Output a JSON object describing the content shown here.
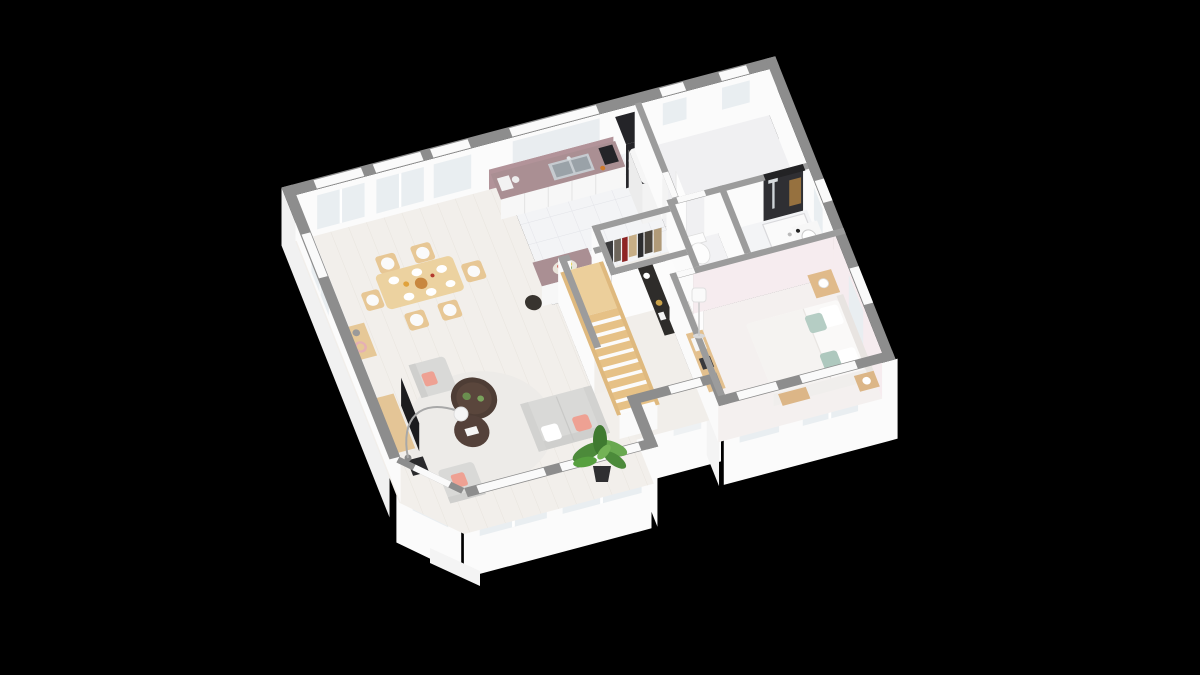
{
  "scene": {
    "background": "#000000",
    "view": "isometric-3d-floor-plan-render",
    "level": "ground-floor"
  },
  "palette": {
    "bg": "#000000",
    "wallTopOuter": "#8d8d8d",
    "wallTopInner": "#9c9c9c",
    "wallFace": "#fbfbfb",
    "wallFaceShade": "#f1f1f1",
    "wallFacePink": "#f6ecef",
    "floorWood": "#f2efeb",
    "floorTile": "#f3f4f6",
    "floorHall": "#f1eeea",
    "floorBedroom": "#f4f0ef",
    "floorBackroom": "#f0f0f2",
    "closetDark": "#323236",
    "glass": "#e9eef1",
    "counter": "#aa8f93",
    "splashback": "#b29399",
    "cabinetFace": "#f7f7f7",
    "fridge": "#f6f6f6",
    "dark": "#242428",
    "woodStair": "#e6c186",
    "woodFurn": "#e3c08e",
    "tableWood": "#ecd2a0",
    "sofa": "#d9d9d7",
    "sofaShade": "#cfcfcd",
    "pillowPink": "#eea193",
    "pillowSage": "#b5cdc4",
    "mattress": "#faf9f8",
    "rug": "#edebe8",
    "tableDark": "#4e3d35",
    "plant": "#4c8a3a",
    "plantLight": "#68a84f",
    "steel": "#c6cbd0",
    "steelDark": "#9aa2a8",
    "caddyWood": "#96713f",
    "white": "#ffffff",
    "clothes": {
      "c1": "#3a3a3c",
      "c2": "#6e665c",
      "c3": "#8e2424",
      "c4": "#c7ae86",
      "c5": "#2c2c2e",
      "c6": "#4a443c",
      "c7": "#b09a78"
    }
  },
  "rooms": [
    "living-room",
    "dining-area",
    "kitchen",
    "utility-room",
    "hallway",
    "staircase",
    "wardrobe-closet",
    "wc",
    "bathroom",
    "bedroom"
  ],
  "furniture": {
    "dining": [
      "dining-table",
      "dining-chairs",
      "tableware",
      "sideboard"
    ],
    "living": [
      "sofa",
      "armchair",
      "armchair",
      "coffee-tables",
      "round-rug",
      "tv",
      "tv-cabinet",
      "speaker",
      "arc-floor-lamp",
      "potted-plant"
    ],
    "kitchen": [
      "counter",
      "double-sink",
      "coffee-machine",
      "island",
      "fruit-bowl",
      "bar-stool",
      "fridge",
      "oven-column"
    ],
    "hallway": [
      "staircase",
      "console-table"
    ],
    "closet": [
      "clothes-rail",
      "hanging-clothes"
    ],
    "wc": [
      "toilet"
    ],
    "bathroom": [
      "walk-in-shower",
      "shower-column",
      "washbasin-counter",
      "toilet"
    ],
    "bedroom": [
      "double-bed",
      "pillows",
      "nightstand",
      "table-lamp",
      "floor-lamp",
      "bookshelf",
      "bench",
      "dresser"
    ]
  }
}
